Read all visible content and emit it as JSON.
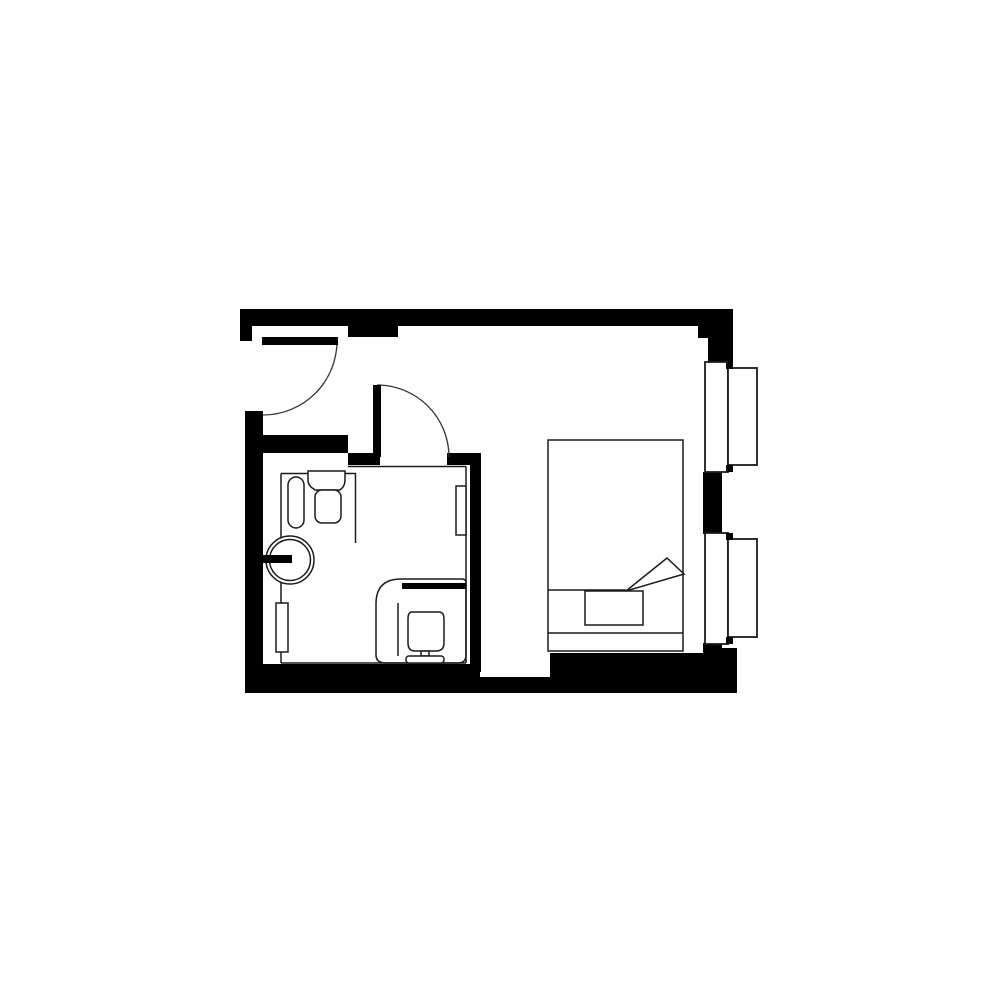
{
  "canvas": {
    "width": 1000,
    "height": 1000,
    "background_color": "#ffffff",
    "wall_color": "#000000",
    "thin_line_color": "#1b1b1b",
    "arc_line_color": "#333333",
    "thin_stroke_width": 1.5,
    "frame_stroke_width": 1.8,
    "arc_stroke_width": 1.3
  },
  "plan": {
    "description_elements": [
      {
        "name": "top-wall",
        "kind": "solid-rect",
        "x": 240,
        "y": 309,
        "w": 493,
        "h": 17
      },
      {
        "name": "top-left-wall-stub",
        "kind": "solid-rect",
        "x": 240,
        "y": 309,
        "w": 12,
        "h": 32
      },
      {
        "name": "top-wall-pier",
        "kind": "solid-rect",
        "x": 348,
        "y": 326,
        "w": 50,
        "h": 11
      },
      {
        "name": "top-right-wall-step",
        "kind": "solid-rect",
        "x": 698,
        "y": 326,
        "w": 35,
        "h": 12
      },
      {
        "name": "top-right-wall-column",
        "kind": "solid-rect",
        "x": 708,
        "y": 338,
        "w": 25,
        "h": 24
      },
      {
        "name": "left-wall",
        "kind": "solid-rect",
        "x": 245,
        "y": 411,
        "w": 18,
        "h": 282
      },
      {
        "name": "bottom-wall-bathroom",
        "kind": "solid-rect",
        "x": 258,
        "y": 664,
        "w": 222,
        "h": 29
      },
      {
        "name": "bottom-wall-nook",
        "kind": "solid-rect",
        "x": 480,
        "y": 677,
        "w": 70,
        "h": 16
      },
      {
        "name": "bottom-wall-main",
        "kind": "solid-rect",
        "x": 550,
        "y": 653,
        "w": 187,
        "h": 40
      },
      {
        "name": "bottom-right-wall-corner",
        "kind": "solid-rect",
        "x": 703,
        "y": 648,
        "w": 34,
        "h": 45
      },
      {
        "name": "right-wall-mid-segment",
        "kind": "solid-rect",
        "x": 703,
        "y": 472,
        "w": 19,
        "h": 62
      },
      {
        "name": "right-wall-lower-segment",
        "kind": "solid-rect",
        "x": 703,
        "y": 643,
        "w": 19,
        "h": 12
      },
      {
        "name": "bathroom-top-wall",
        "kind": "solid-rect",
        "x": 263,
        "y": 435,
        "w": 85,
        "h": 18
      },
      {
        "name": "bathroom-doorjamb-left",
        "kind": "solid-rect",
        "x": 348,
        "y": 453,
        "w": 32,
        "h": 12
      },
      {
        "name": "bathroom-doorjamb-right",
        "kind": "solid-rect",
        "x": 447,
        "y": 453,
        "w": 34,
        "h": 12
      },
      {
        "name": "bathroom-right-wall",
        "kind": "solid-rect",
        "x": 470,
        "y": 453,
        "w": 11,
        "h": 219
      },
      {
        "name": "bathroom-outline-left",
        "kind": "line",
        "x1": 281,
        "y1": 473.5,
        "x2": 281,
        "y2": 663
      },
      {
        "name": "bathroom-outline-top",
        "kind": "line",
        "x1": 348,
        "y1": 466.5,
        "x2": 466,
        "y2": 466.5
      },
      {
        "name": "bathroom-outline-right",
        "kind": "line",
        "x1": 466,
        "y1": 466.5,
        "x2": 466,
        "y2": 663
      },
      {
        "name": "bathroom-outline-bottom",
        "kind": "line",
        "x1": 281,
        "y1": 663,
        "x2": 466,
        "y2": 663
      },
      {
        "name": "vanity-counter-front",
        "kind": "line",
        "x1": 281,
        "y1": 473.5,
        "x2": 356,
        "y2": 473.5
      },
      {
        "name": "vanity-counter-side",
        "kind": "line",
        "x1": 355.5,
        "y1": 473.5,
        "x2": 355.5,
        "y2": 543
      },
      {
        "name": "towel-radiator",
        "kind": "rrect",
        "x": 288,
        "y": 477,
        "w": 16,
        "h": 51,
        "rx": 8
      },
      {
        "name": "sink-backsplash",
        "kind": "path",
        "d": "M 308 471 H 345 V 480 Q 345 486 341 489 L 340 490 H 315 L 314 489 Q 308 486 308 480 Z",
        "fill": "#ffffff"
      },
      {
        "name": "sink-bowl",
        "kind": "rrect",
        "x": 315,
        "y": 490,
        "w": 26,
        "h": 33,
        "rx": 7
      },
      {
        "name": "round-washbasin-outer",
        "kind": "circle",
        "cx": 290,
        "cy": 560,
        "r": 24
      },
      {
        "name": "round-washbasin-inner",
        "kind": "circle",
        "cx": 290,
        "cy": 560,
        "r": 20.5
      },
      {
        "name": "washbasin-tap",
        "kind": "solid-rect",
        "x": 262,
        "y": 555,
        "w": 30,
        "h": 8
      },
      {
        "name": "wall-panel-left",
        "kind": "frame-rect",
        "x": 276,
        "y": 603,
        "w": 12,
        "h": 49
      },
      {
        "name": "wall-panel-right",
        "kind": "frame-rect",
        "x": 456,
        "y": 486,
        "w": 10,
        "h": 49
      },
      {
        "name": "toilet-area-outline",
        "kind": "path",
        "d": "M 401 579 H 462 Q 466 579 466 583 V 655 Q 466 663 458 663 H 386 Q 376 663 376 655 V 604 Q 376 579 401 579 Z",
        "fill": "none"
      },
      {
        "name": "toilet-shelf",
        "kind": "solid-rect",
        "x": 402,
        "y": 583,
        "w": 64,
        "h": 6
      },
      {
        "name": "shower-glass-line",
        "kind": "line",
        "x1": 398,
        "y1": 603,
        "x2": 398,
        "y2": 656
      },
      {
        "name": "toilet-bowl",
        "kind": "path",
        "d": "M 412 612 H 439 Q 444 612 444 619 V 643 Q 444 651 436 651 H 415 Q 408 651 408 643 V 619 Q 408 612 412 612 Z",
        "fill": "#ffffff"
      },
      {
        "name": "toilet-stem",
        "kind": "frame-rect",
        "x": 421,
        "y": 651,
        "w": 8,
        "h": 5
      },
      {
        "name": "toilet-cistern",
        "kind": "rrect",
        "x": 406,
        "y": 656,
        "w": 38,
        "h": 7,
        "rx": 3
      },
      {
        "name": "entry-door-swing-arc",
        "kind": "arc-path",
        "d": "M 337 341 A 74 74 0 0 1 263 415"
      },
      {
        "name": "entry-door-leaf",
        "kind": "solid-rect",
        "x": 262,
        "y": 337,
        "w": 76,
        "h": 8
      },
      {
        "name": "bathroom-door-swing-arc",
        "kind": "arc-path",
        "d": "M 377 385 A 72 72 0 0 1 449 457"
      },
      {
        "name": "bathroom-door-leaf",
        "kind": "solid-rect",
        "x": 373,
        "y": 385,
        "w": 8,
        "h": 72
      },
      {
        "name": "bed-frame",
        "kind": "frame-rect",
        "x": 548,
        "y": 440,
        "w": 135,
        "h": 211
      },
      {
        "name": "bed-blanket-line",
        "kind": "line",
        "x1": 548,
        "y1": 590,
        "x2": 626,
        "y2": 590
      },
      {
        "name": "bed-pillow",
        "kind": "frame-rect",
        "x": 585,
        "y": 591,
        "w": 58,
        "h": 34
      },
      {
        "name": "bed-headboard-line",
        "kind": "line",
        "x1": 548,
        "y1": 633,
        "x2": 683,
        "y2": 633
      },
      {
        "name": "bed-blanket-fold",
        "kind": "path",
        "d": "M 626 591 L 667 558 L 684 574 Z",
        "fill": "#ffffff"
      },
      {
        "name": "window1-inner-sash",
        "kind": "frame-rect",
        "x": 705,
        "y": 362,
        "w": 23,
        "h": 110,
        "sw": 1.8
      },
      {
        "name": "window1-outer-sash",
        "kind": "frame-rect",
        "x": 728,
        "y": 368,
        "w": 29,
        "h": 97,
        "sw": 1.8
      },
      {
        "name": "window1-mullion-top",
        "kind": "solid-rect",
        "x": 726,
        "y": 362,
        "w": 7,
        "h": 7
      },
      {
        "name": "window1-mullion-bottom",
        "kind": "solid-rect",
        "x": 726,
        "y": 465,
        "w": 7,
        "h": 7
      },
      {
        "name": "window2-inner-sash",
        "kind": "frame-rect",
        "x": 705,
        "y": 533,
        "w": 23,
        "h": 111,
        "sw": 1.8
      },
      {
        "name": "window2-outer-sash",
        "kind": "frame-rect",
        "x": 728,
        "y": 539,
        "w": 29,
        "h": 98,
        "sw": 1.8
      },
      {
        "name": "window2-mullion-top",
        "kind": "solid-rect",
        "x": 726,
        "y": 533,
        "w": 7,
        "h": 7
      },
      {
        "name": "window2-mullion-bottom",
        "kind": "solid-rect",
        "x": 726,
        "y": 637,
        "w": 7,
        "h": 7
      }
    ]
  }
}
